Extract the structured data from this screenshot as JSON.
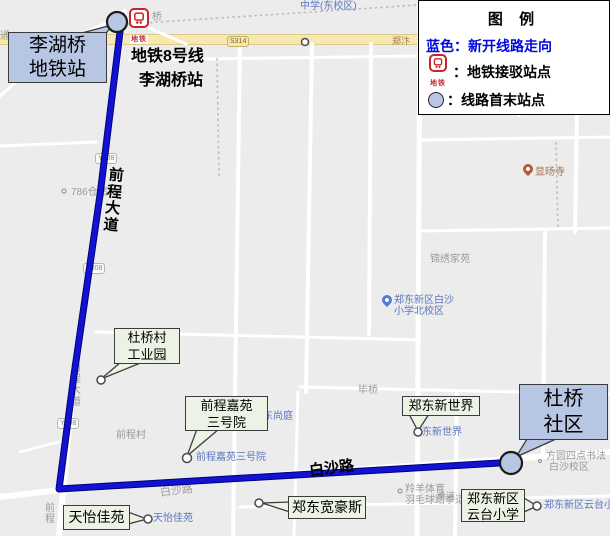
{
  "legend": {
    "title": "图  例",
    "blue_line_label": "蓝色：新开线路走向",
    "blue_color": "#0008dd",
    "metro_row_label": "：地铁接驳站点",
    "terminal_row_label": "：线路首末站点",
    "metro_icon_text": "地铁"
  },
  "route": {
    "color": "#1212cf",
    "station_annotation_line1": "地铁8号线",
    "station_annotation_line2": "李湖桥站",
    "metro_icon_text": "地铁"
  },
  "callouts": {
    "lihuqiao": {
      "line1": "李湖桥",
      "line2": "地铁站"
    },
    "duqiao_shequ": {
      "line1": "杜桥",
      "line2": "社区"
    },
    "duqiaocun": {
      "line1": "杜桥村",
      "line2": "工业园"
    },
    "qiancheng": {
      "line1": "前程嘉苑",
      "line2": "三号院"
    },
    "xinshijie": {
      "label": "郑东新世界"
    },
    "tianyi": {
      "label": "天怡佳苑"
    },
    "kuanhaosi": {
      "label": "郑东宽豪斯"
    },
    "yuntai": {
      "line1": "郑东新区",
      "line2": "云台小学"
    }
  },
  "road_annotations": {
    "qianchengdadao": "前程大道",
    "baishalu": "白沙路"
  },
  "map_labels": [
    {
      "text": "中学(东校区)"
    },
    {
      "text": "郑汴"
    },
    {
      "text": "桥"
    },
    {
      "text": "786仓储"
    },
    {
      "text": "显旸寺"
    },
    {
      "text": "锦绣家苑"
    },
    {
      "text": "郑东新区白沙"
    },
    {
      "text": "小学北校区"
    },
    {
      "text": "毕桥"
    },
    {
      "text": "郑东尚庭"
    },
    {
      "text": "前程嘉苑三号院"
    },
    {
      "text": "东新世界"
    },
    {
      "text": "方圆四点书法"
    },
    {
      "text": "白沙校区"
    },
    {
      "text": "羚羊体育"
    },
    {
      "text": "羽毛球跆拳道"
    },
    {
      "text": "郑东新区云台小学"
    },
    {
      "text": "天怡佳苑"
    },
    {
      "text": "前程村"
    },
    {
      "text": "前程"
    },
    {
      "text": "前程大道"
    },
    {
      "text": "白沙路"
    },
    {
      "text": "通"
    },
    {
      "text": "拳道"
    }
  ],
  "shields": [
    {
      "text": "S314"
    },
    {
      "text": "Y008"
    },
    {
      "text": "Y008"
    },
    {
      "text": "Y008"
    }
  ]
}
